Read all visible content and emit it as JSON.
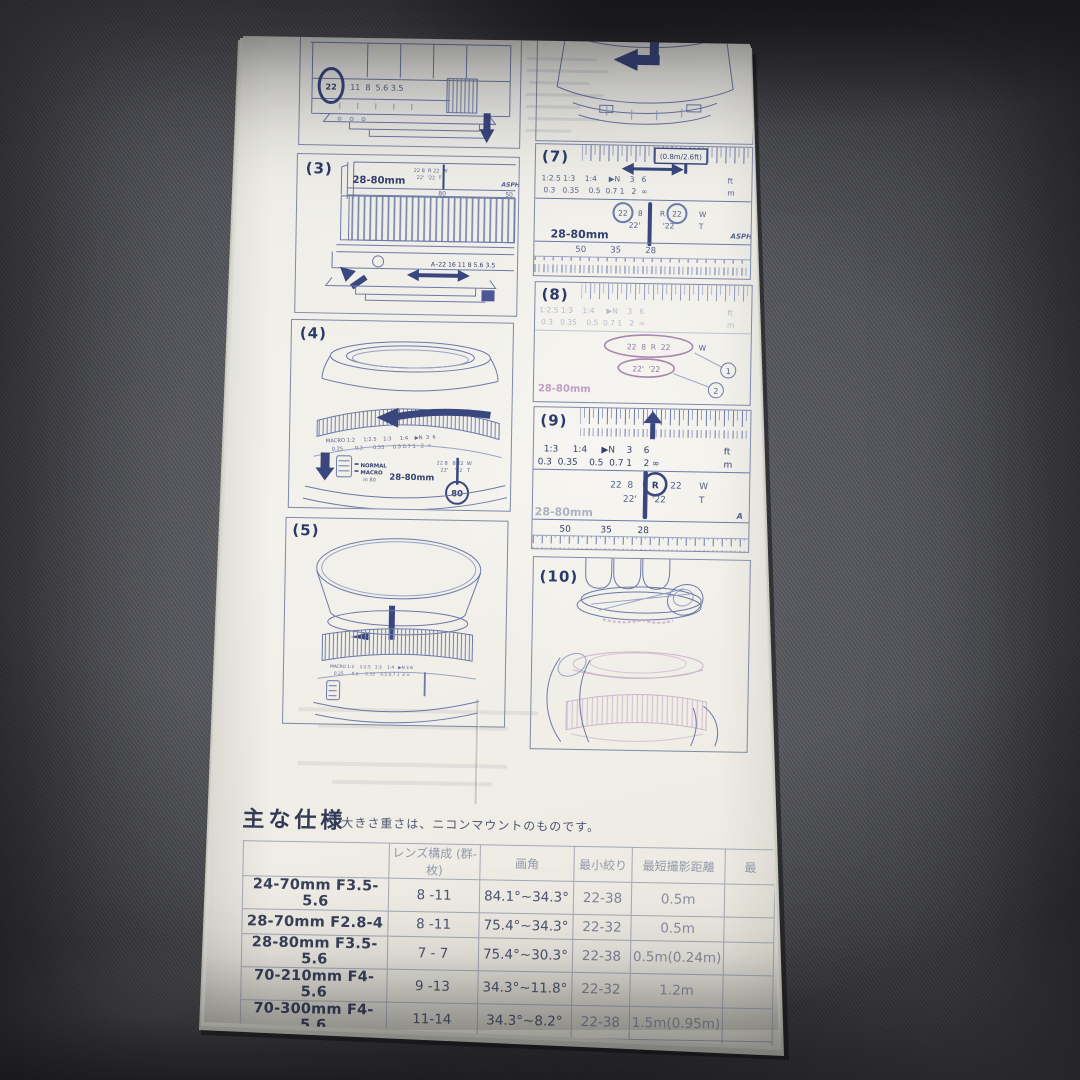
{
  "photo": {
    "ink_color": "#3a477f",
    "faded_ink_color": "#b389b6",
    "paper_color": "#f0efe9",
    "fabric_color": "#4f5055"
  },
  "figures": {
    "fig2": {
      "aperture_circled": "22",
      "aperture_values": "11  8  5.6 3.5"
    },
    "fig3": {
      "label": "(3)",
      "lens_name": "28-80mm",
      "logo": "ASPH",
      "zoom_80": "80",
      "zoom_50": "50",
      "cluster_top": "22 8  R 22  W",
      "cluster_bottom": "22'  '22  T",
      "aperture_row": "A–22 16 11 8 5.6 3.5"
    },
    "fig4": {
      "label": "(4)",
      "scale_row1": "MACRO 1:2     1:2.5    1:3     1:4    ▶N  3  6",
      "scale_row2": "0.25       0.3      0.35     0.5 0.7 1   2  ∞",
      "switch_line1": "NORMAL",
      "switch_line2": "MACRO",
      "switch_line3": "in 80",
      "lens_name": "28-80mm",
      "zoom_circled": "80",
      "cluster_top": "22 8   8 22  W",
      "cluster_bottom": "22'    '22   T"
    },
    "fig5": {
      "label": "(5)",
      "scale_row1": "MACRO 1:2    1:2.5   1:3    1:4   ▶N 3 6",
      "scale_row2": "0.25      0.3     0.35    0.5 0.7 1  2 ∞"
    },
    "fig7": {
      "label": "(7)",
      "callout": "(0.8m/2.6ft)",
      "scale_row1": "1:2.5 1:3    1:4     ▶N    3   6",
      "scale_unit1": "ft",
      "scale_row2": "0.3   0.35    0.5  0.7 1   2  ∞",
      "scale_unit2": "m",
      "f22": "22",
      "f8": "8",
      "r": "R",
      "w": "W",
      "t": "T",
      "sub_left": "22'",
      "sub_right": "'22",
      "lens_name": "28-80mm",
      "logo": "ASPH",
      "z50": "50",
      "z35": "35",
      "z28": "28"
    },
    "fig8": {
      "label": "(8)",
      "scale_row1": "1:2.5 1:3    1:4     ▶N    3   6",
      "scale_unit1": "ft",
      "scale_row2": "0.3   0.35    0.5  0.7 1   2  ∞",
      "scale_unit2": "m",
      "oval1": "22  8  R  22",
      "w": "W",
      "marker1": "1",
      "oval2": "22'  '22",
      "marker2": "2",
      "lens_name": "28-80mm"
    },
    "fig9": {
      "label": "(9)",
      "scale_row1": "1:3     1:4     ▶N    3    6",
      "scale_unit1": "ft",
      "scale_row2": "0.3  0.35    0.5  0.7 1    2 ∞",
      "scale_unit2": "m",
      "ap_left": "22  8",
      "r": "R",
      "f22": "22",
      "w": "W",
      "sub_left": "22'",
      "sub_right": "'22",
      "t": "T",
      "lens_name": "28-80mm",
      "z50": "50",
      "z35": "35",
      "z28": "28",
      "logo": "A"
    },
    "fig10": {
      "label": "(10)"
    }
  },
  "specs": {
    "title": "主な仕様",
    "note": "大きさ重さは、ニコンマウントのものです。",
    "columns": [
      "",
      "レンズ構成 (群-枚)",
      "画角",
      "最小絞り",
      "最短撮影距離",
      "最"
    ],
    "rows": [
      [
        "24-70mm F3.5-5.6",
        "8 -11",
        "84.1°~34.3°",
        "22-38",
        "0.5m"
      ],
      [
        "28-70mm F2.8-4",
        "8 -11",
        "75.4°~34.3°",
        "22-32",
        "0.5m"
      ],
      [
        "28-80mm F3.5-5.6",
        "7 - 7",
        "75.4°~30.3°",
        "22-38",
        "0.5m(0.24m)"
      ],
      [
        "70-210mm F4-5.6",
        "9 -13",
        "34.3°~11.8°",
        "22-32",
        "1.2m"
      ],
      [
        "70-300mm F4-5.6",
        "11-14",
        "34.3°~8.2°",
        "22-38",
        "1.5m(0.95m)"
      ],
      [
        "100-300mm F4.5-6.7",
        "10 -13",
        "24.4°~8.2°",
        "22-32",
        "2m"
      ]
    ]
  }
}
